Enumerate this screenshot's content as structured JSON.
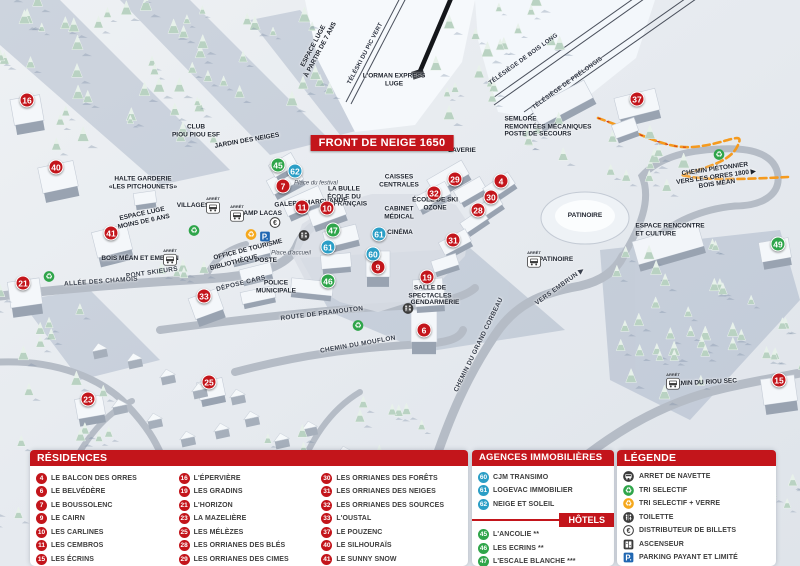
{
  "map": {
    "badge": "FRONT DE NEIGE 1650",
    "arret_label": "ARRÊT",
    "labels": [
      {
        "text": "TÉLÉSKI DU PIC VERT",
        "x": 366,
        "y": 54,
        "rot": -62,
        "cls": "lift"
      },
      {
        "text": "TÉLÉSIÈGE DE BOIS LONG",
        "x": 524,
        "y": 60,
        "rot": -36,
        "cls": "lift"
      },
      {
        "text": "TÉLÉSIÈGE DE PRÉLONGIS",
        "x": 568,
        "y": 84,
        "rot": -36,
        "cls": "lift"
      },
      {
        "text": "L'ORMAN EXPRESS\nLUGE",
        "x": 394,
        "y": 80,
        "rot": 0,
        "cls": "fac"
      },
      {
        "text": "ESPACE LUGE\nÀ PARTIR DE 7 ANS",
        "x": 317,
        "y": 48,
        "rot": -62,
        "cls": "fac"
      },
      {
        "text": "SEMLORE\nREMONTÉES MÉCANIQUES\nPOSTE DE SECOURS",
        "x": 548,
        "y": 127,
        "rot": 0,
        "cls": "facL"
      },
      {
        "text": "CLUB\nPIOU PIOU ESF",
        "x": 196,
        "y": 131,
        "rot": 0,
        "cls": "fac"
      },
      {
        "text": "JARDIN DES NEIGES",
        "x": 247,
        "y": 141,
        "rot": -10,
        "cls": "fac"
      },
      {
        "text": "LAVERIE",
        "x": 462,
        "y": 151,
        "rot": 0,
        "cls": "fac"
      },
      {
        "text": "CAISSES\nCENTRALES",
        "x": 399,
        "y": 181,
        "rot": 0,
        "cls": "fac"
      },
      {
        "text": "Place du festival",
        "x": 316,
        "y": 184,
        "rot": 0,
        "cls": "it"
      },
      {
        "text": "LA BULLE\nÉCOLE DU\nSKI FRANÇAIS",
        "x": 344,
        "y": 197,
        "rot": 0,
        "cls": "fac"
      },
      {
        "text": "GALERIE MARCHANDE",
        "x": 311,
        "y": 203,
        "rot": -4,
        "cls": "fac"
      },
      {
        "text": "ÉCOLE DE SKI\nOZONE",
        "x": 435,
        "y": 204,
        "rot": 0,
        "cls": "fac"
      },
      {
        "text": "CABINET\nMÉDICAL",
        "x": 399,
        "y": 213,
        "rot": 0,
        "cls": "fac"
      },
      {
        "text": "CINÉMA",
        "x": 400,
        "y": 233,
        "rot": 0,
        "cls": "fac"
      },
      {
        "text": "HALTE GARDERIE\n«LES PITCHOUNETS»",
        "x": 143,
        "y": 183,
        "rot": 0,
        "cls": "fac"
      },
      {
        "text": "ESPACE LUGE\nMOINS DE 6 ANS",
        "x": 143,
        "y": 218,
        "rot": -12,
        "cls": "fac"
      },
      {
        "text": "VILLAGES",
        "x": 193,
        "y": 206,
        "rot": 0,
        "cls": "fac"
      },
      {
        "text": "CHAMP LACAS",
        "x": 258,
        "y": 214,
        "rot": 0,
        "cls": "fac"
      },
      {
        "text": "BOIS MÉAN ET EMBRUN",
        "x": 140,
        "y": 259,
        "rot": 0,
        "cls": "fac"
      },
      {
        "text": "PONT SKIEURS",
        "x": 152,
        "y": 273,
        "rot": -8,
        "cls": "road"
      },
      {
        "text": "ALLÉE DES CHAMOIS",
        "x": 101,
        "y": 282,
        "rot": -4,
        "cls": "road"
      },
      {
        "text": "OFFICE DE TOURISME",
        "x": 248,
        "y": 250,
        "rot": -14,
        "cls": "fac"
      },
      {
        "text": "BIBLIOTHÈQUE",
        "x": 234,
        "y": 263,
        "rot": -14,
        "cls": "fac"
      },
      {
        "text": "POSTE",
        "x": 266,
        "y": 261,
        "rot": 0,
        "cls": "fac"
      },
      {
        "text": "Place d'accueil",
        "x": 291,
        "y": 254,
        "rot": 0,
        "cls": "it"
      },
      {
        "text": "DÉPOSE CARS",
        "x": 241,
        "y": 284,
        "rot": -14,
        "cls": "road"
      },
      {
        "text": "POLICE\nMUNICIPALE",
        "x": 276,
        "y": 287,
        "rot": 0,
        "cls": "fac"
      },
      {
        "text": "ROUTE DE PRAMOUTON",
        "x": 322,
        "y": 314,
        "rot": -7,
        "cls": "road"
      },
      {
        "text": "CHEMIN DU MOUFLON",
        "x": 358,
        "y": 345,
        "rot": -10,
        "cls": "road"
      },
      {
        "text": "CHEMIN DU GRAND CORBEAU",
        "x": 479,
        "y": 345,
        "rot": -64,
        "cls": "road"
      },
      {
        "text": "VERS EMBRUN ▶",
        "x": 560,
        "y": 287,
        "rot": -36,
        "cls": "road"
      },
      {
        "text": "SALLE DE\nSPECTACLES",
        "x": 430,
        "y": 292,
        "rot": 0,
        "cls": "fac"
      },
      {
        "text": "GENDARMERIE",
        "x": 435,
        "y": 303,
        "rot": 0,
        "cls": "fac"
      },
      {
        "text": "PATINOIRE",
        "x": 585,
        "y": 216,
        "rot": 0,
        "cls": "fac"
      },
      {
        "text": "PATINOIRE",
        "x": 556,
        "y": 260,
        "rot": 0,
        "cls": "fac"
      },
      {
        "text": "ESPACE RENCONTRE\nET CULTURE",
        "x": 670,
        "y": 230,
        "rot": 0,
        "cls": "facL"
      },
      {
        "text": "CHEMIN PIÉTONNIER\nVERS LES ORRES 1800 ▶\nBOIS MÉAN",
        "x": 716,
        "y": 177,
        "rot": -8,
        "cls": "fac"
      },
      {
        "text": "CHEMIN DU RIOU SEC",
        "x": 702,
        "y": 383,
        "rot": -3,
        "cls": "fac"
      }
    ],
    "markers": [
      {
        "n": "16",
        "x": 27,
        "y": 100,
        "type": "res"
      },
      {
        "n": "40",
        "x": 56,
        "y": 167,
        "type": "res"
      },
      {
        "n": "41",
        "x": 111,
        "y": 233,
        "type": "res"
      },
      {
        "n": "21",
        "x": 23,
        "y": 283,
        "type": "res"
      },
      {
        "n": "33",
        "x": 204,
        "y": 296,
        "type": "res"
      },
      {
        "n": "23",
        "x": 88,
        "y": 399,
        "type": "res"
      },
      {
        "n": "25",
        "x": 209,
        "y": 382,
        "type": "res"
      },
      {
        "n": "7",
        "x": 283,
        "y": 186,
        "type": "res"
      },
      {
        "n": "11",
        "x": 302,
        "y": 207,
        "type": "res"
      },
      {
        "n": "10",
        "x": 327,
        "y": 208,
        "type": "res"
      },
      {
        "n": "9",
        "x": 378,
        "y": 267,
        "type": "res"
      },
      {
        "n": "29",
        "x": 455,
        "y": 179,
        "type": "res"
      },
      {
        "n": "32",
        "x": 434,
        "y": 193,
        "type": "res"
      },
      {
        "n": "4",
        "x": 501,
        "y": 181,
        "type": "res"
      },
      {
        "n": "30",
        "x": 491,
        "y": 197,
        "type": "res"
      },
      {
        "n": "28",
        "x": 478,
        "y": 210,
        "type": "res"
      },
      {
        "n": "31",
        "x": 453,
        "y": 240,
        "type": "res"
      },
      {
        "n": "19",
        "x": 427,
        "y": 277,
        "type": "res"
      },
      {
        "n": "6",
        "x": 424,
        "y": 330,
        "type": "res"
      },
      {
        "n": "37",
        "x": 637,
        "y": 99,
        "type": "res"
      },
      {
        "n": "15",
        "x": 779,
        "y": 380,
        "type": "res"
      },
      {
        "n": "45",
        "x": 278,
        "y": 165,
        "type": "hotel"
      },
      {
        "n": "47",
        "x": 333,
        "y": 230,
        "type": "hotel"
      },
      {
        "n": "46",
        "x": 328,
        "y": 281,
        "type": "hotel"
      },
      {
        "n": "49",
        "x": 778,
        "y": 244,
        "type": "hotel"
      },
      {
        "n": "62",
        "x": 295,
        "y": 171,
        "type": "agency"
      },
      {
        "n": "61",
        "x": 328,
        "y": 247,
        "type": "agency"
      },
      {
        "n": "61",
        "x": 379,
        "y": 234,
        "type": "agency"
      },
      {
        "n": "60",
        "x": 373,
        "y": 254,
        "type": "agency"
      }
    ],
    "bus_stops": [
      {
        "x": 213,
        "y": 205
      },
      {
        "x": 237,
        "y": 213
      },
      {
        "x": 170,
        "y": 257
      },
      {
        "x": 534,
        "y": 259
      },
      {
        "x": 673,
        "y": 381
      }
    ],
    "amenities": [
      {
        "type": "parking",
        "x": 265,
        "y": 238
      },
      {
        "type": "euro",
        "x": 275,
        "y": 224
      },
      {
        "type": "toilet",
        "x": 304,
        "y": 237
      },
      {
        "type": "toilet",
        "x": 408,
        "y": 310
      },
      {
        "type": "recycle-green",
        "x": 49,
        "y": 278
      },
      {
        "type": "recycle-green",
        "x": 194,
        "y": 232
      },
      {
        "type": "recycle-green",
        "x": 358,
        "y": 327
      },
      {
        "type": "recycle-green",
        "x": 719,
        "y": 156
      },
      {
        "type": "recycle-orange",
        "x": 251,
        "y": 236
      }
    ]
  },
  "legend": {
    "residences": {
      "title": "RÉSIDENCES",
      "columns": [
        [
          {
            "num": "4",
            "name": "LE BALCON DES ORRES"
          },
          {
            "num": "6",
            "name": "LE BELVÉDÈRE"
          },
          {
            "num": "7",
            "name": "LE BOUSSOLENC"
          },
          {
            "num": "9",
            "name": "LE CAIRN"
          },
          {
            "num": "10",
            "name": "LES CARLINES"
          },
          {
            "num": "11",
            "name": "LES CEMBROS"
          },
          {
            "num": "15",
            "name": "LES ÉCRINS"
          }
        ],
        [
          {
            "num": "16",
            "name": "L'ÉPERVIÈRE"
          },
          {
            "num": "19",
            "name": "LES GRADINS"
          },
          {
            "num": "21",
            "name": "L'HORIZON"
          },
          {
            "num": "23",
            "name": "LA MAZELIÈRE"
          },
          {
            "num": "25",
            "name": "LES MÉLÈZES"
          },
          {
            "num": "28",
            "name": "LES ORRIANES DES BLÉS"
          },
          {
            "num": "29",
            "name": "LES ORRIANES DES CIMES"
          }
        ],
        [
          {
            "num": "30",
            "name": "LES ORRIANES DES FORÊTS"
          },
          {
            "num": "31",
            "name": "LES ORRIANES DES NEIGES"
          },
          {
            "num": "32",
            "name": "LES ORRIANES DES SOURCES"
          },
          {
            "num": "33",
            "name": "L'OUSTAL"
          },
          {
            "num": "37",
            "name": "LE POUZENC"
          },
          {
            "num": "40",
            "name": "LE SILHOURAÏS"
          },
          {
            "num": "41",
            "name": "LE SUNNY SNOW"
          }
        ]
      ]
    },
    "agences": {
      "title": "AGENCES IMMOBILIÈRES",
      "items": [
        {
          "num": "60",
          "name": "CJM TRANSIMO"
        },
        {
          "num": "61",
          "name": "LOGEVAC IMMOBILIER"
        },
        {
          "num": "62",
          "name": "NEIGE ET SOLEIL"
        }
      ]
    },
    "hotels": {
      "title": "HÔTELS",
      "items": [
        {
          "num": "45",
          "name": "L'ANCOLIE **"
        },
        {
          "num": "46",
          "name": "LES ECRINS **"
        },
        {
          "num": "47",
          "name": "L'ESCALE BLANCHE ***"
        },
        {
          "num": "49",
          "name": "LES TRAPPEURS **"
        }
      ]
    },
    "legende": {
      "title": "LÉGENDE",
      "items": [
        {
          "icon": "bus",
          "label": "ARRET DE NAVETTE"
        },
        {
          "icon": "recycle-green",
          "label": "TRI SELECTIF"
        },
        {
          "icon": "recycle-orange",
          "label": "TRI SELECTIF + VERRE"
        },
        {
          "icon": "toilet",
          "label": "TOILETTE"
        },
        {
          "icon": "euro",
          "label": "DISTRIBUTEUR DE BILLETS"
        },
        {
          "icon": "elevator",
          "label": "ASCENSEUR"
        },
        {
          "icon": "parking",
          "label": "PARKING PAYANT ET LIMITÉ"
        }
      ]
    }
  },
  "colors": {
    "header_red": "#c3151b",
    "marker_red": "#c3151b",
    "marker_green": "#2fa54a",
    "marker_blue": "#2b9ec6",
    "recycle_green": "#2fa54a",
    "recycle_orange": "#f5a81c",
    "parking_blue": "#2067b2",
    "icon_dark": "#3b3b3b",
    "path_orange": "#f59a1e"
  }
}
